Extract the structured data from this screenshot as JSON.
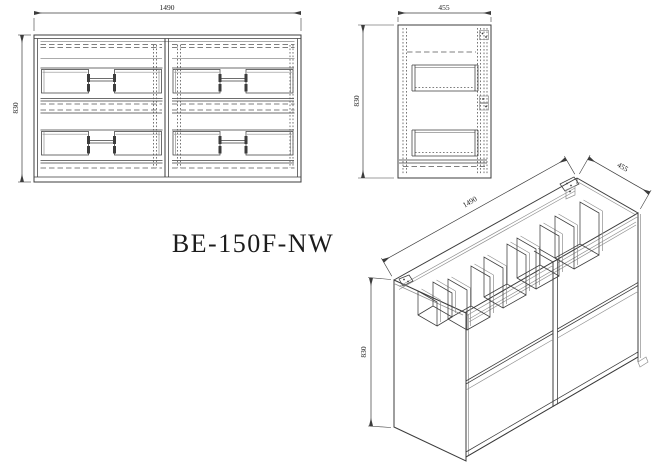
{
  "title": "BE-150F-NW",
  "front_view": {
    "width": "1490",
    "height": "830"
  },
  "side_view": {
    "width": "455",
    "height": "830"
  },
  "iso_view": {
    "length": "1490",
    "depth": "455",
    "height": "830"
  },
  "colors": {
    "line": "#3c3c3c",
    "line_light": "#8f8f8f",
    "dashed": "#555555",
    "background": "#ffffff",
    "text": "#1c1c1c"
  }
}
